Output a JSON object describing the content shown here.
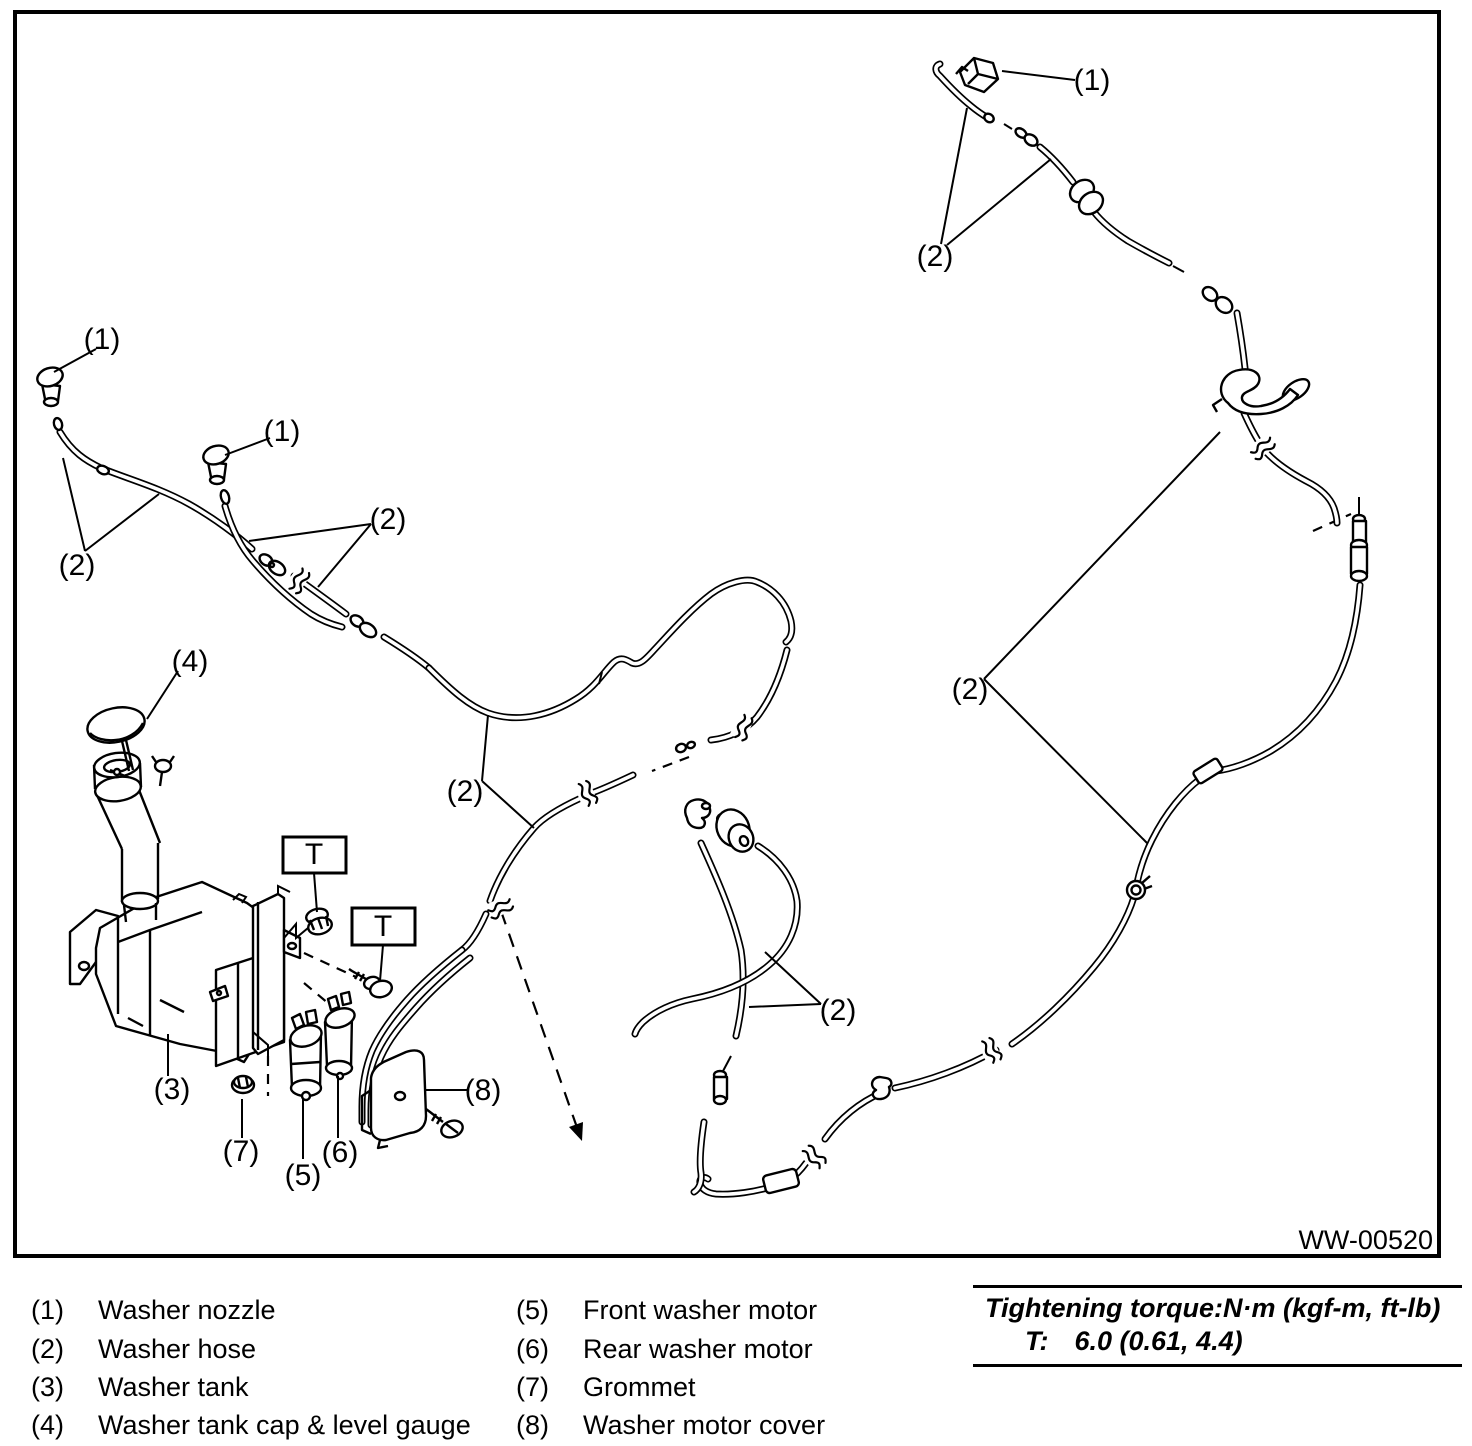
{
  "figure": {
    "code": "WW-00520"
  },
  "colors": {
    "line": "#000000",
    "background": "#ffffff"
  },
  "callouts": [
    {
      "id": "rear-washer-nozzle",
      "text": "(1)"
    },
    {
      "id": "rear-washer-hose-top",
      "text": "(2)"
    },
    {
      "id": "front-washer-nozzle-left",
      "text": "(1)"
    },
    {
      "id": "front-washer-nozzle-right",
      "text": "(1)"
    },
    {
      "id": "front-washer-hose-left",
      "text": "(2)"
    },
    {
      "id": "front-washer-hose-mid",
      "text": "(2)"
    },
    {
      "id": "washer-tank-cap",
      "text": "(4)"
    },
    {
      "id": "front-washer-hose-center",
      "text": "(2)"
    },
    {
      "id": "rear-washer-hose-right",
      "text": "(2)"
    },
    {
      "id": "mid-washer-hose",
      "text": "(2)"
    },
    {
      "id": "washer-tank",
      "text": "(3)"
    },
    {
      "id": "grommet",
      "text": "(7)"
    },
    {
      "id": "front-washer-motor",
      "text": "(5)"
    },
    {
      "id": "rear-washer-motor",
      "text": "(6)"
    },
    {
      "id": "washer-motor-cover",
      "text": "(8)"
    },
    {
      "id": "torque-t1",
      "text": "T"
    },
    {
      "id": "torque-t2",
      "text": "T"
    }
  ],
  "legend": {
    "items": [
      {
        "num": "(1)",
        "label": "Washer nozzle"
      },
      {
        "num": "(2)",
        "label": "Washer hose"
      },
      {
        "num": "(3)",
        "label": "Washer tank"
      },
      {
        "num": "(4)",
        "label": "Washer tank cap & level gauge"
      },
      {
        "num": "(5)",
        "label": "Front washer motor"
      },
      {
        "num": "(6)",
        "label": "Rear washer motor"
      },
      {
        "num": "(7)",
        "label": "Grommet"
      },
      {
        "num": "(8)",
        "label": "Washer motor cover"
      }
    ]
  },
  "torque_note": {
    "title": "Tightening torque:N·m (kgf-m, ft-lb)",
    "symbol": "T:",
    "value": "6.0 (0.61, 4.4)"
  }
}
